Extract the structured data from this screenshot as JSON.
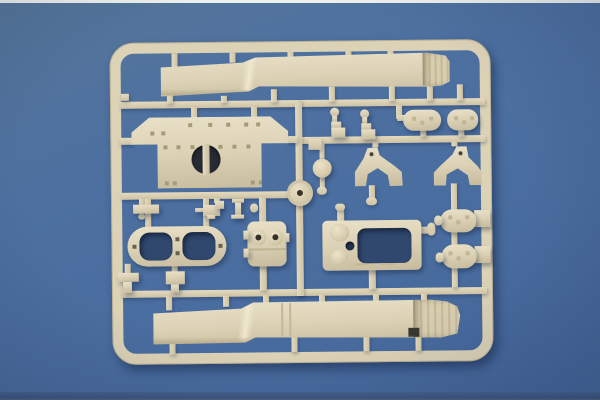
{
  "meta": {
    "description": "Product photo of a tan injection-molded plastic model-kit sprue (parts tree) lying on a blue backdrop",
    "text_content": "none - the photo contains no readable text"
  },
  "colors": {
    "backdrop_blue": "#4c6fa0",
    "backdrop_blue_dark": "#41618f",
    "edge_white": "#eff1ef",
    "edge_bottom_blue": "#3c5680",
    "plastic": "#dcd2b6",
    "plastic_highlight": "#e9e1c8",
    "plastic_shadow": "#c7bb9d",
    "plastic_deep": "#a89c7d",
    "through_hole_blue": "#30476e",
    "recess_dark": "#262a33",
    "cast_shadow": "rgba(14,29,58,0.38)"
  },
  "sprue": {
    "frame_label": "rounded rectangular sprue frame",
    "runner_label": "runner bar",
    "gate_label": "sprue gate stub",
    "parts": {
      "top_fender": {
        "label": "long stepped fender strip with curled ribbed end (upper)"
      },
      "hull_top_plate": {
        "label": "wide hull plate with angled shoulders, riveted, round opening with center bar"
      },
      "idler_disc": {
        "label": "small round disc with center hole"
      },
      "periscope_knob_1": {
        "label": "small ball-top stepped knob"
      },
      "periscope_knob_2": {
        "label": "small ball-top stepped knob"
      },
      "fuel_tank_1": {
        "label": "oval tank half (left)"
      },
      "fuel_tank_2": {
        "label": "oval tank half (right)"
      },
      "bracket_1": {
        "label": "arched gusset bracket (left)"
      },
      "bracket_2": {
        "label": "arched gusset bracket (right)"
      },
      "ball_mount": {
        "label": "round ball mount with stems"
      },
      "mg_mount": {
        "label": "small machine-gun mount with flanged spool"
      },
      "small_bar": {
        "label": "small rectangular bar"
      },
      "twin_hatch_ring": {
        "label": "rounded twin-opening hatch ring"
      },
      "periscope_box": {
        "label": "rounded box with two drilled bosses"
      },
      "engine_deck_plate": {
        "label": "deck plate with large rectangular cutout, two domed bosses and through-hole"
      },
      "stowage_pod_1": {
        "label": "dimpled rounded pod with side knob (upper)"
      },
      "stowage_pod_2": {
        "label": "dimpled rounded pod with side knob (lower)"
      },
      "clamp_1": {
        "label": "small T-shaped clamp"
      },
      "clamp_2": {
        "label": "small block clamp"
      },
      "bottom_fender": {
        "label": "long stepped fender strip with curled ribbed end (lower)"
      }
    }
  }
}
